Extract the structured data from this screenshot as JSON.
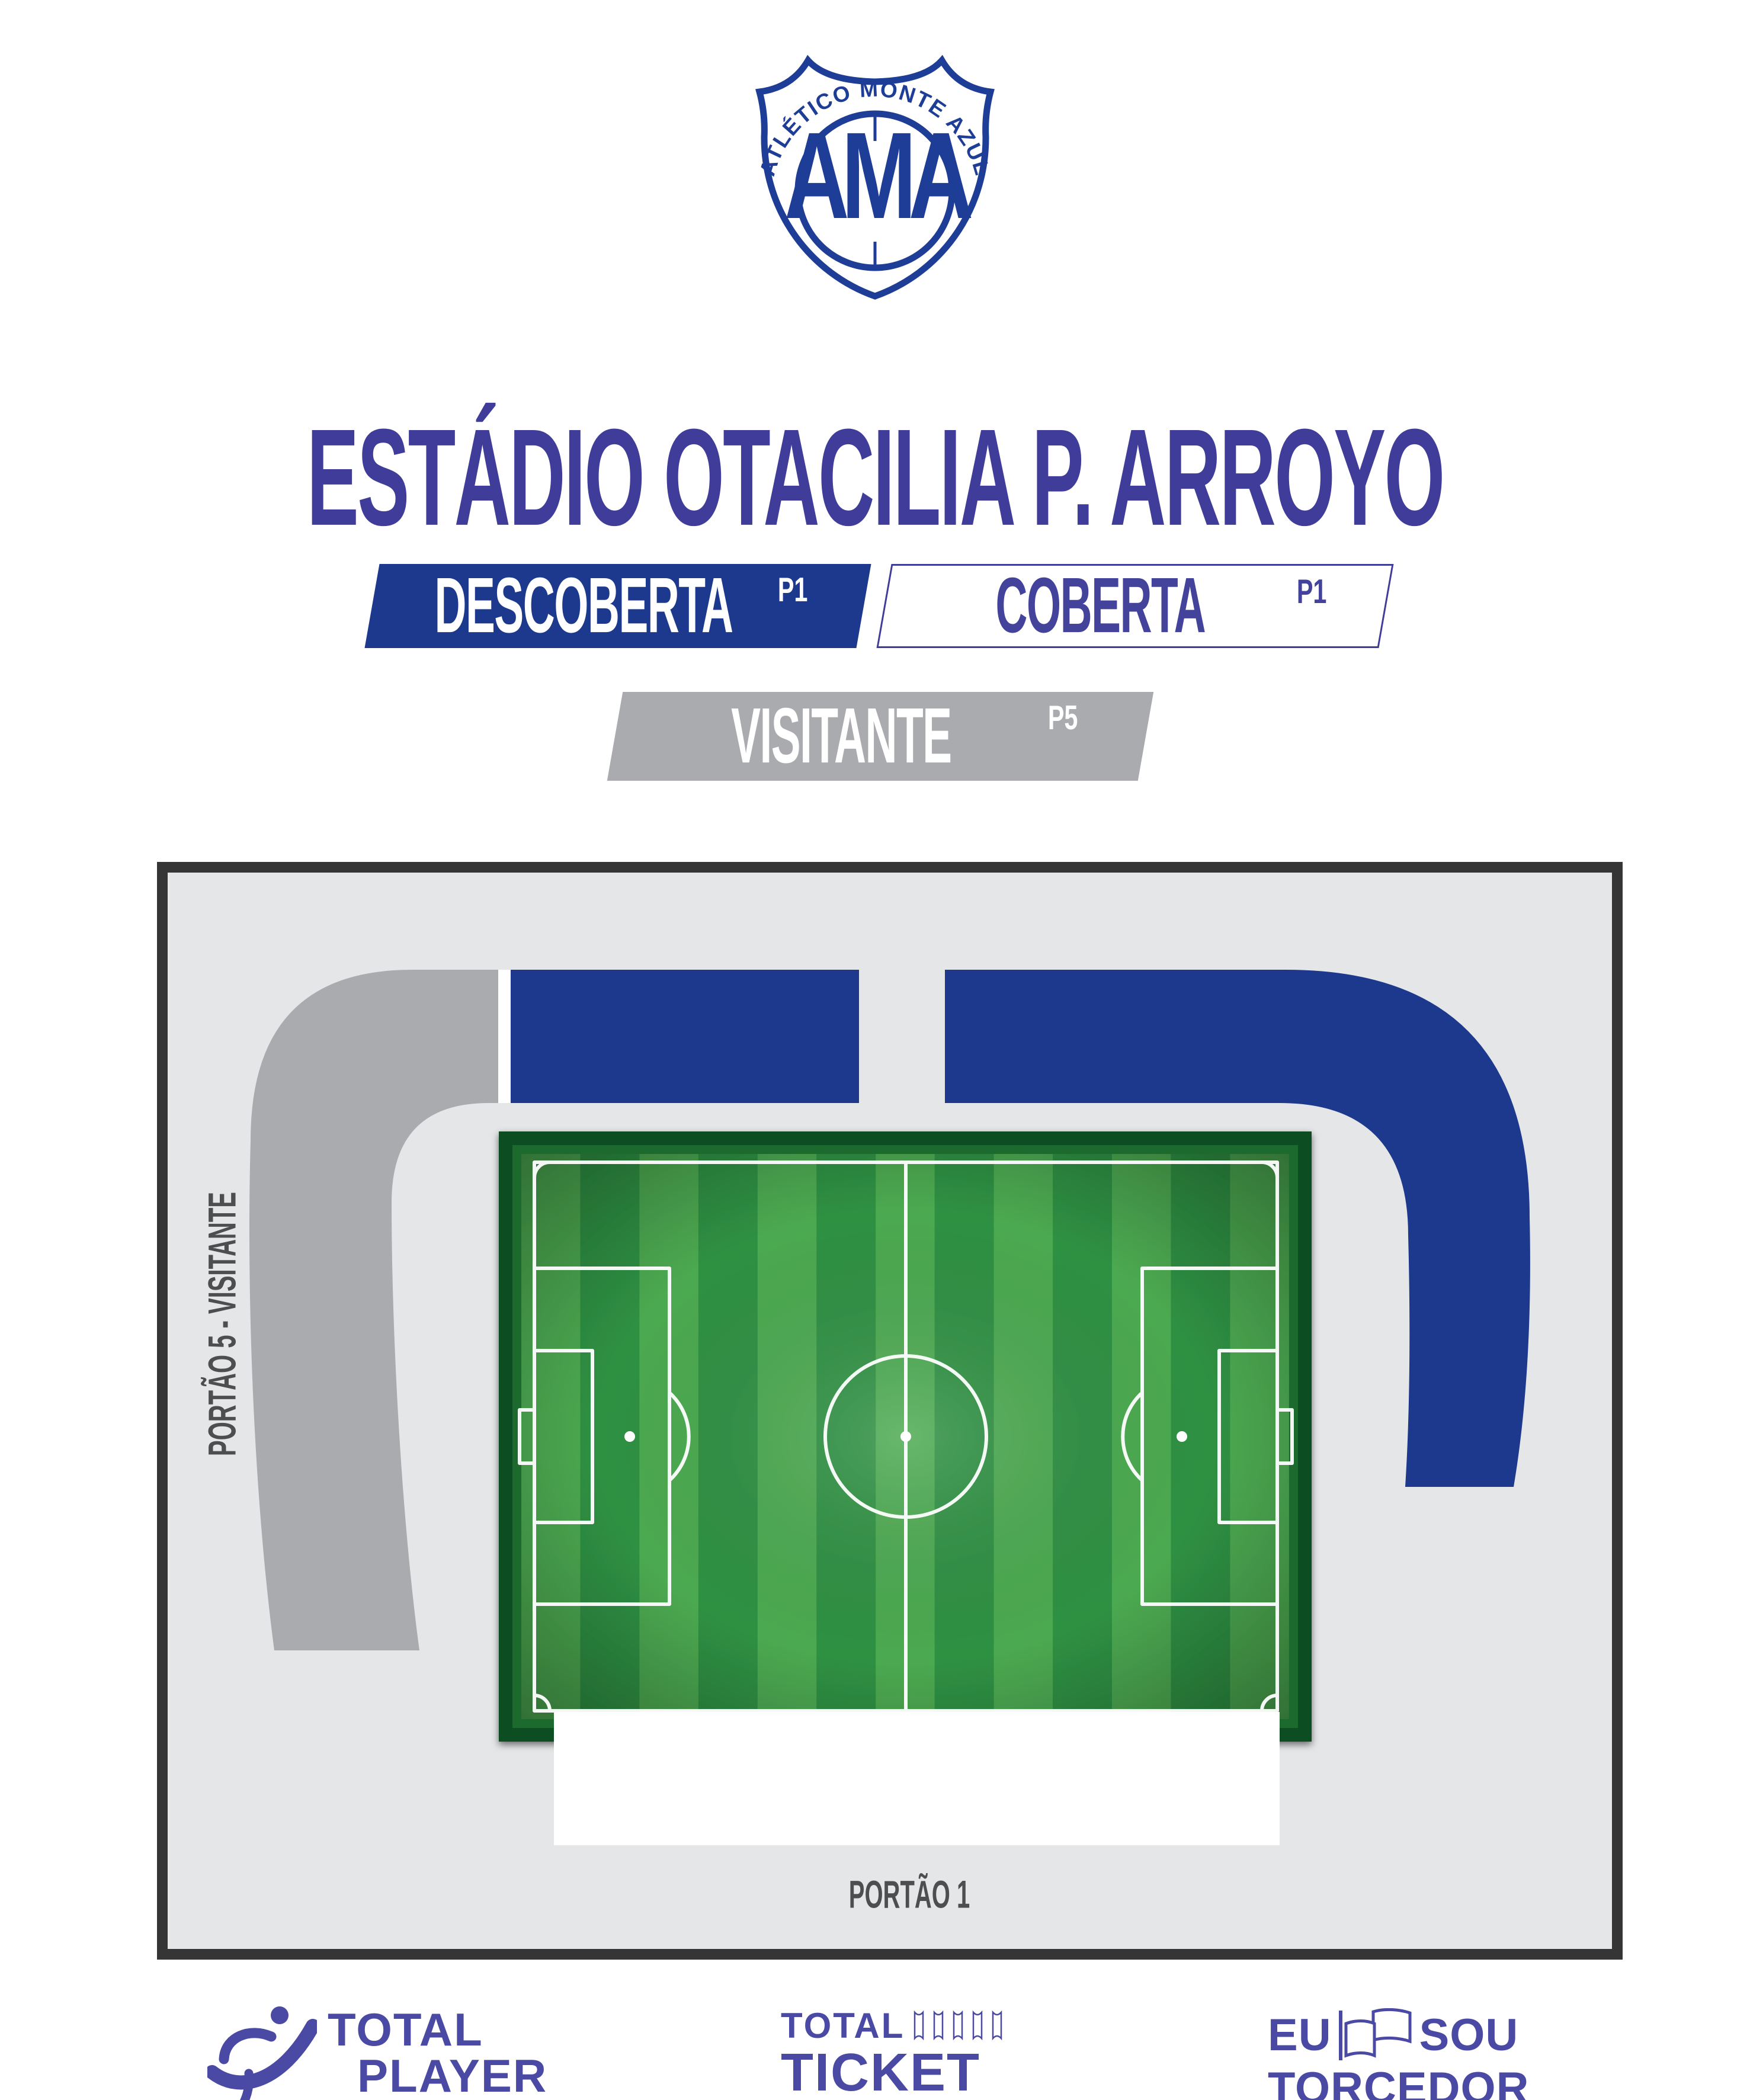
{
  "header": {
    "club_arc_text": "ATLÉTICO MONTE AZUL",
    "club_monogram": "AMA",
    "stadium_title": "ESTÁDIO OTACILIA P. ARROYO"
  },
  "legend": {
    "descoberta": {
      "label": "DESCOBERTA",
      "gate": "P1"
    },
    "coberta": {
      "label": "COBERTA",
      "gate": "P1"
    },
    "visitante": {
      "label": "VISITANTE",
      "gate": "P5"
    }
  },
  "map": {
    "gate_left_label": "PORTÃO 5 - VISITANTE",
    "gate_bottom_label": "PORTÃO 1"
  },
  "sponsors": {
    "total_player": {
      "line1": "TOTAL",
      "line2": "PLAYER"
    },
    "total_ticket": {
      "line1": "TOTAL",
      "line2": "TICKET"
    },
    "eu_sou_torcedor": {
      "word1": "EU",
      "word2": "SOU",
      "line2": "TORCEDOR"
    }
  },
  "colors": {
    "crest_blue": "#1e3d96",
    "title_indigo": "#3f3d99",
    "stand_blue": "#1c398d",
    "stand_silver": "#a9abae",
    "map_background": "#e5e6e7",
    "map_border": "#353536",
    "field_frame_green": "#0b4e20",
    "stripe_light_green": "#4caa51",
    "stripe_dark_green": "#2f9143",
    "gate_label_gray": "#4d4e50",
    "sponsor_indigo": "#4a49a4"
  }
}
